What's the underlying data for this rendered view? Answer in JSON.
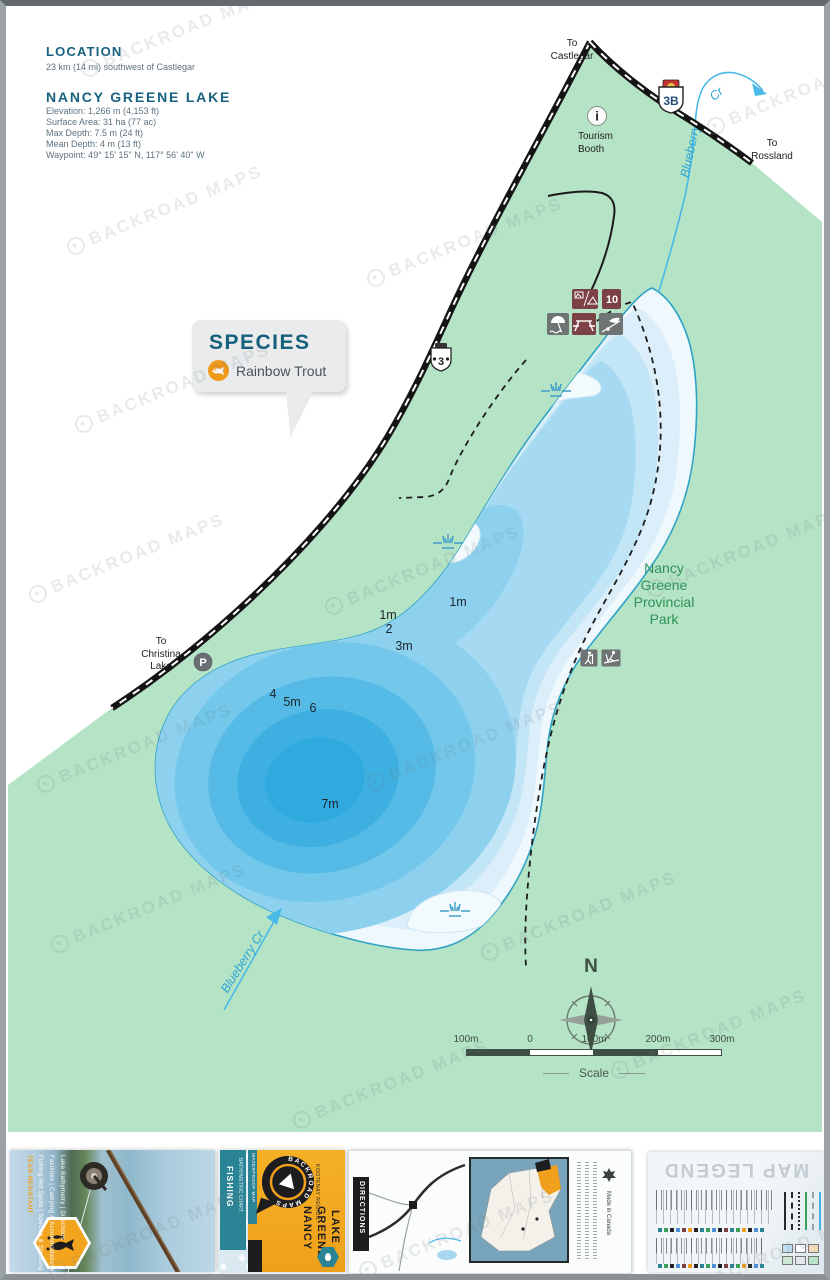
{
  "page": {
    "watermark_text": "BACKROAD MAPS"
  },
  "header": {
    "location_title": "LOCATION",
    "location_text": "23 km (14 mi) southwest of Castlegar",
    "lake_title": "NANCY GREENE LAKE",
    "stats_lines": [
      "Elevation: 1,266 m (4,153 ft)",
      "Surface Area: 31 ha (77 ac)",
      "Max Depth: 7.5 m (24 ft)",
      "Mean Depth: 4 m (13 ft)",
      "Waypoint: 49° 15' 15\" N, 117° 56' 40\" W"
    ]
  },
  "species": {
    "title": "SPECIES",
    "fish": "Rainbow Trout"
  },
  "map": {
    "labels": {
      "castlegar": [
        "To",
        "Castlegar"
      ],
      "rossland": [
        "To",
        "Rossland"
      ],
      "christina": [
        "To",
        "Christina",
        "Lake"
      ],
      "tourism": [
        "Tourism",
        "Booth"
      ],
      "park": [
        "Nancy",
        "Greene",
        "Provincial",
        "Park"
      ]
    },
    "shields": {
      "hwy3b": "3B",
      "hwy3": "3"
    },
    "parking": "P",
    "tourism_icon": "i",
    "campsites": "10",
    "depths": [
      "1m",
      "1m",
      "2",
      "3m",
      "4",
      "5m",
      "6",
      "7m"
    ],
    "creeks": {
      "top_name": "Blueberry",
      "top_abbr": "Cr",
      "bottom": "Blueberry Cr"
    },
    "compass": "N",
    "scale": {
      "ticks": [
        "100m",
        "0",
        "100m",
        "200m",
        "300m"
      ],
      "caption": "Scale"
    }
  },
  "covers": {
    "photo_panel": {
      "highlight": "TEAR-RESISTANT",
      "features": [
        "Fishing Hot Spots | Species & Stocking",
        "Facilities | Camping & Accommodations",
        "Lake Bathymetry | Directions"
      ]
    },
    "front_panel": {
      "banner_top": "FISHING",
      "banner_sub": "BATHYMETRIC CHART",
      "logo_text": "BACKROAD MAPS",
      "ribbon": "WATERPROOF MAP",
      "title": [
        "NANCY",
        "GREENE",
        "LAKE"
      ],
      "region": "KOOTENAY REGION"
    },
    "back_panel": {
      "directions": "DIRECTIONS",
      "made_in": "Made in Canada"
    },
    "legend_panel": {
      "title": "MAP LEGEND"
    }
  },
  "colors": {
    "park_green": "#b5e3c6",
    "lake_deep": "#2fa9de",
    "heading_teal": "#17627f",
    "accent_orange": "#f09a1c",
    "icon_maroon": "#7c4145",
    "icon_gray": "#6d7473"
  }
}
